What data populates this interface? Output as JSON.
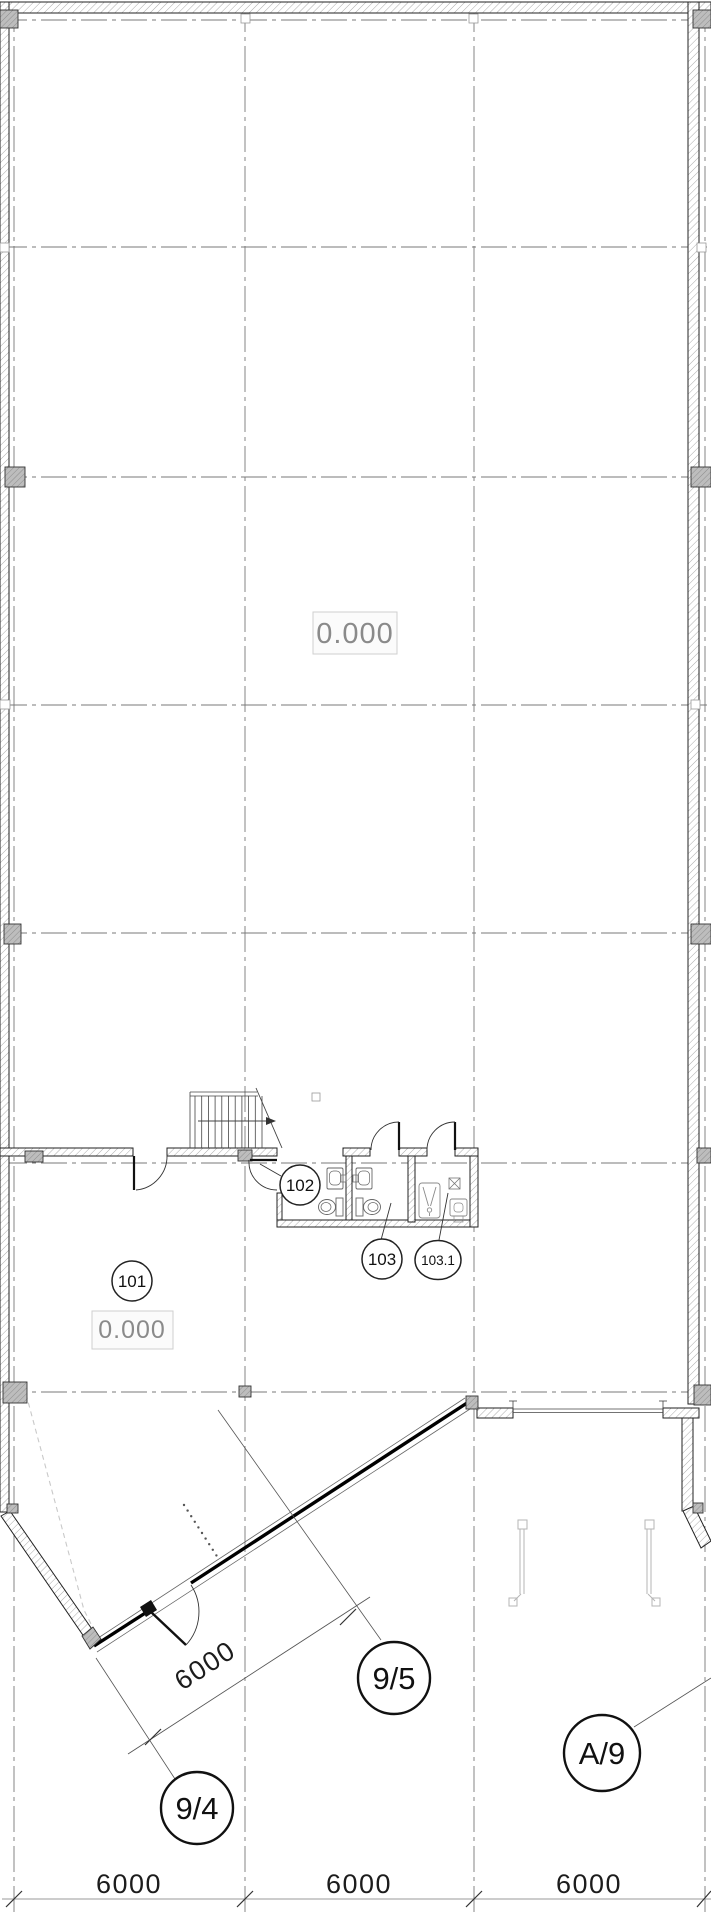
{
  "plan": {
    "elevation_hall": "0.000",
    "elevation_101": "0.000",
    "room_101": "101",
    "room_102": "102",
    "room_103": "103",
    "room_103_1": "103.1",
    "axis_9_4": "9/4",
    "axis_9_5": "9/5",
    "axis_a_9": "A/9",
    "dim_bottom_1": "6000",
    "dim_bottom_2": "6000",
    "dim_bottom_3": "6000",
    "dim_diagonal": "6000",
    "colors": {
      "wall_line": "#222222",
      "grid_line": "#777777",
      "column_fill": "#bdbdbd",
      "muted_text": "#8a8a8a"
    }
  }
}
